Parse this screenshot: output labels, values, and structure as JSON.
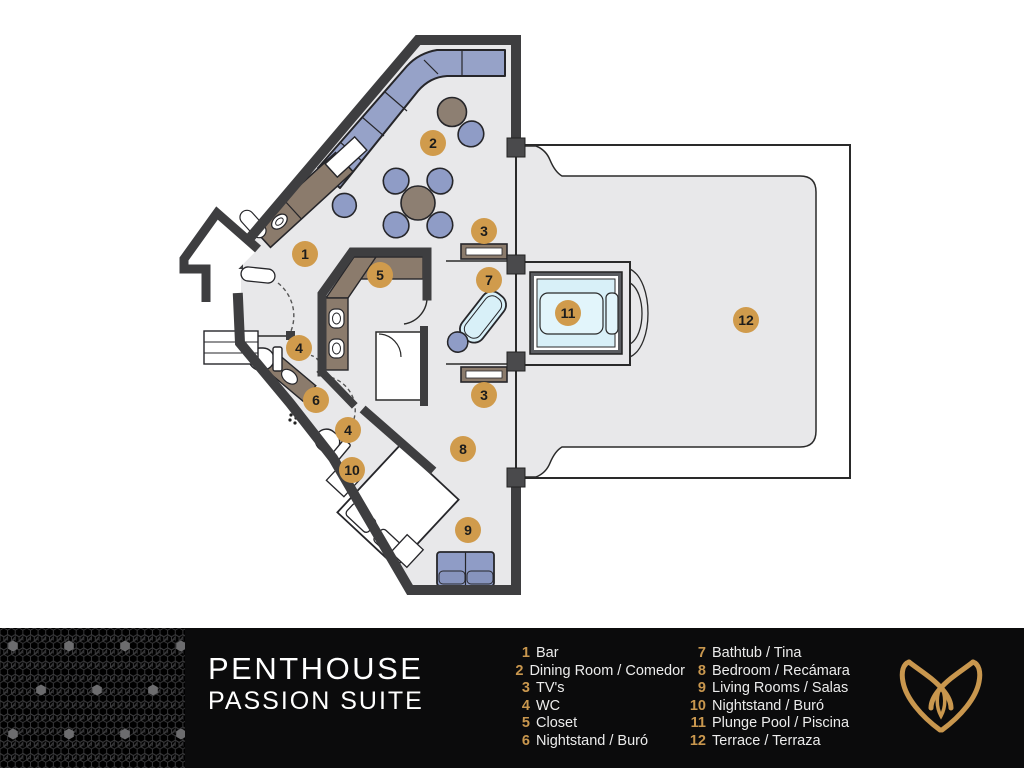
{
  "title": {
    "line1": "PENTHOUSE",
    "line2": "PASSION SUITE"
  },
  "legend": {
    "column1": [
      {
        "n": "1",
        "label": "Bar"
      },
      {
        "n": "2",
        "label": "Dining Room / Comedor"
      },
      {
        "n": "3",
        "label": "TV's"
      },
      {
        "n": "4",
        "label": "WC"
      },
      {
        "n": "5",
        "label": "Closet"
      },
      {
        "n": "6",
        "label": "Nightstand / Buró"
      }
    ],
    "column2": [
      {
        "n": "7",
        "label": "Bathtub / Tina"
      },
      {
        "n": "8",
        "label": "Bedroom / Recámara"
      },
      {
        "n": "9",
        "label": "Living Rooms / Salas"
      },
      {
        "n": "10",
        "label": "Nightstand / Buró"
      },
      {
        "n": "11",
        "label": "Plunge Pool / Piscina"
      },
      {
        "n": "12",
        "label": "Terrace / Terraza"
      }
    ]
  },
  "markers": [
    {
      "n": "1",
      "x": 305,
      "y": 254
    },
    {
      "n": "2",
      "x": 433,
      "y": 143
    },
    {
      "n": "3",
      "x": 484,
      "y": 231
    },
    {
      "n": "3",
      "x": 484,
      "y": 395
    },
    {
      "n": "4",
      "x": 299,
      "y": 348
    },
    {
      "n": "4",
      "x": 348,
      "y": 430
    },
    {
      "n": "5",
      "x": 380,
      "y": 275
    },
    {
      "n": "6",
      "x": 316,
      "y": 400
    },
    {
      "n": "7",
      "x": 489,
      "y": 280
    },
    {
      "n": "8",
      "x": 463,
      "y": 449
    },
    {
      "n": "9",
      "x": 468,
      "y": 530
    },
    {
      "n": "10",
      "x": 352,
      "y": 470
    },
    {
      "n": "11",
      "x": 568,
      "y": 313
    },
    {
      "n": "12",
      "x": 746,
      "y": 320
    }
  ],
  "colors": {
    "accent_gold": "#c9974e",
    "marker_fill": "#d09b4c",
    "marker_text": "#1c1c1c",
    "wall": "#3e3e40",
    "floor": "#e8e8ea",
    "furniture_blue": "#94a0c7",
    "furniture_brown": "#8b7b6c",
    "water": "#d8f0f8",
    "footer_bg": "#0b0b0c",
    "legend_text": "#ececec"
  },
  "logo": {
    "name": "antler-brand-mark"
  }
}
